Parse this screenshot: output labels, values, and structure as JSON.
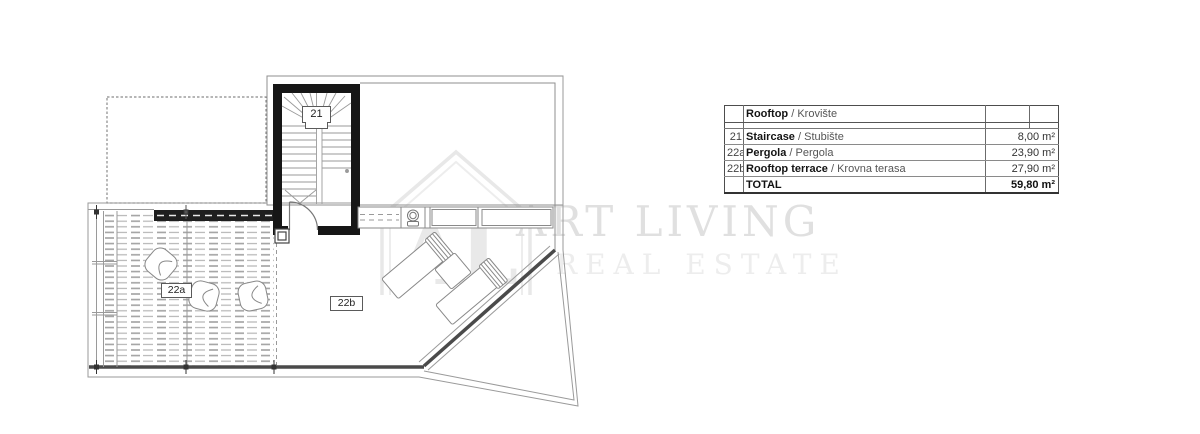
{
  "watermark": {
    "monogram": "AL",
    "title": "ART LIVING",
    "subtitle": "REAL ESTATE"
  },
  "plan_labels": {
    "staircase": "21",
    "pergola": "22a",
    "rooftop_terrace": "22b"
  },
  "table": {
    "header": {
      "title_en": "Rooftop",
      "separator": " / ",
      "title_hr": "Krovište"
    },
    "rows": [
      {
        "no": "21",
        "name_en": "Staircase",
        "separator": " / ",
        "name_hr": "Stubište",
        "area": "8,00 m²"
      },
      {
        "no": "22a",
        "name_en": "Pergola",
        "separator": " / ",
        "name_hr": "Pergola",
        "area": "23,90 m²"
      },
      {
        "no": "22b",
        "name_en": "Rooftop terrace",
        "separator": " / ",
        "name_hr": "Krovna terasa",
        "area": "27,90 m²"
      }
    ],
    "total": {
      "label": "TOTAL",
      "area": "59,80 m²"
    }
  }
}
